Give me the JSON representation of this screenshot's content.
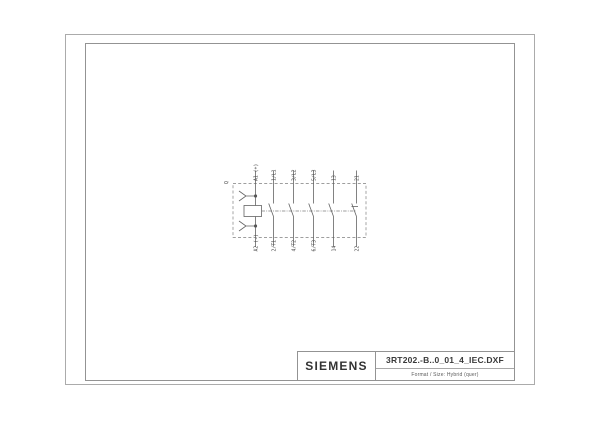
{
  "colors": {
    "background": "#ffffff",
    "outer_border": "#ababab",
    "inner_frame": "#939393",
    "schematic_line": "#636363",
    "text": "#3a3a3a"
  },
  "title_block": {
    "brand": "SIEMENS",
    "drawing_name": "3RT202.-B..0_01_4_IEC.DXF",
    "format_note": "Format / Size: Hybrid (quer)"
  },
  "schematic": {
    "device_label": "Q",
    "coil": {
      "top": "A1 (+)",
      "bottom": "A2 (-)"
    },
    "poles": [
      {
        "top": "1/L1",
        "bottom": "2/T1",
        "kind": "NO"
      },
      {
        "top": "3/L2",
        "bottom": "4/T2",
        "kind": "NO"
      },
      {
        "top": "5/L3",
        "bottom": "6/T3",
        "kind": "NO"
      },
      {
        "top": "13",
        "bottom": "14",
        "kind": "NO"
      },
      {
        "top": "21",
        "bottom": "22",
        "kind": "NC"
      }
    ]
  }
}
